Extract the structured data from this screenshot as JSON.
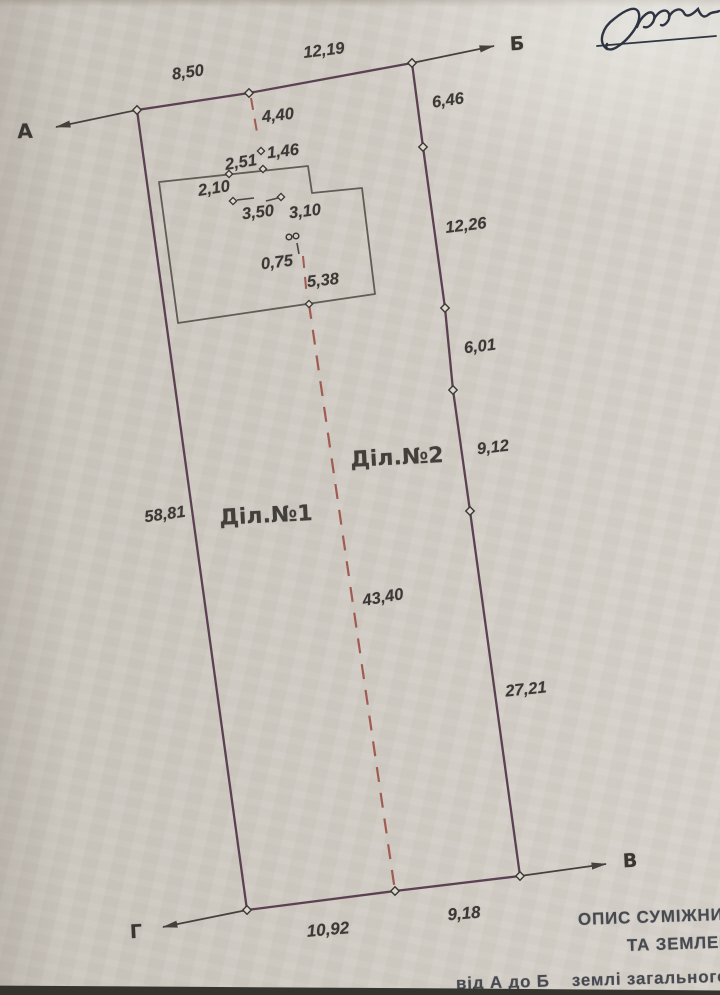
{
  "plan": {
    "corners": {
      "a": "А",
      "b": "Б",
      "v": "В",
      "g": "Г"
    },
    "parcels": {
      "p1": "Діл.№1",
      "p2": "Діл.№2"
    },
    "dims": {
      "top1": "8,50",
      "top2": "12,19",
      "r1": "6,46",
      "r2": "12,26",
      "r3": "6,01",
      "r4": "9,12",
      "r5": "27,21",
      "left": "58,81",
      "b1": "10,92",
      "b2": "9,18",
      "split": "43,40",
      "h_offset": "4,40",
      "h_gap": "1,46",
      "h_top1": "2,51",
      "h_top2": "2,10",
      "h_in1": "3,50",
      "h_in2": "3,10",
      "h_in3": "0,75",
      "h_in4": "5,38"
    },
    "footer": {
      "line1": "ОПИС СУМІЖНИХ",
      "line2": "ТА ЗЕМЛЕК",
      "line3": "від А до Б    землі загального"
    },
    "colors": {
      "paper": "#d4cfc7",
      "boundary_line": "#5c4153",
      "split_line": "#a05b52",
      "drawing_ink": "#3b3835",
      "footer_ink": "#474a51",
      "signature_ink": "#2e3442"
    }
  }
}
